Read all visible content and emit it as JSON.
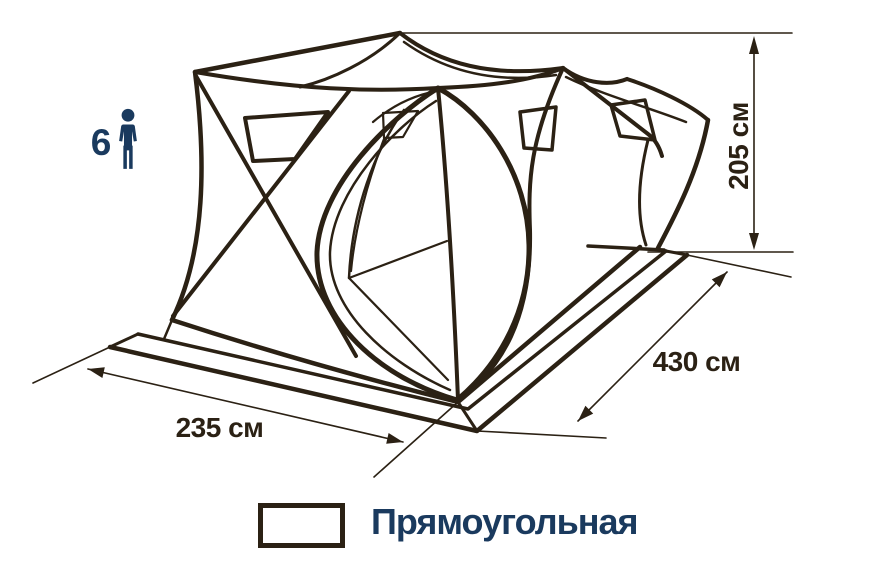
{
  "diagram": {
    "subject": "double-cube-tent-line-drawing",
    "capacity": {
      "value": "6",
      "icon": "person-icon"
    },
    "dimensions": {
      "height": {
        "label": "205 см",
        "value": 205,
        "unit": "см"
      },
      "length": {
        "label": "430 см",
        "value": 430,
        "unit": "см"
      },
      "width": {
        "label": "235 см",
        "value": 235,
        "unit": "см"
      }
    },
    "legend": {
      "shape_label": "Прямоугольная",
      "icon": "rectangle-outline-icon"
    }
  },
  "colors": {
    "ink": "#2b2114",
    "accent": "#1a3a5e",
    "background": "#ffffff"
  }
}
